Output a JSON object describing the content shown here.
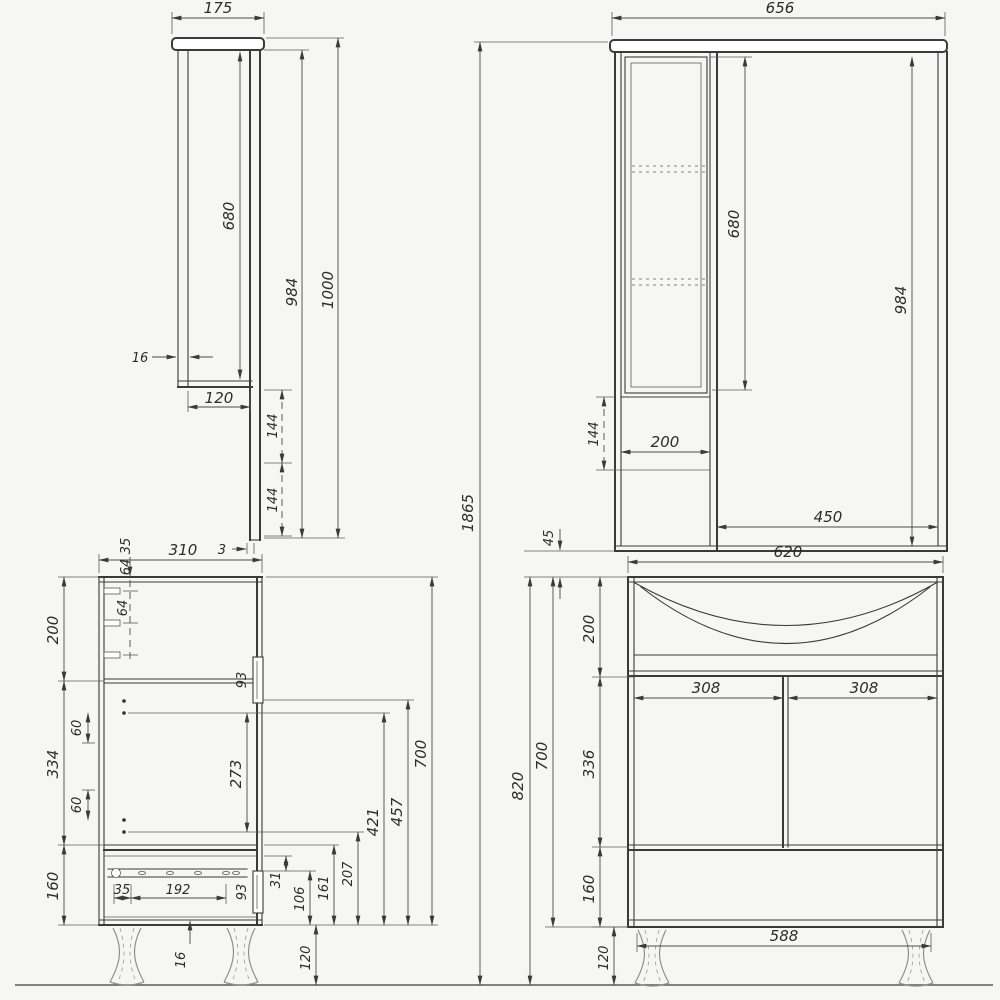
{
  "drawing": {
    "background": "#f6f6f4",
    "line_color": "#3a3a3a",
    "views": {
      "mirror_side": {
        "depth": "175",
        "door_height": "680",
        "height_no_cap": "984",
        "total_height": "1000",
        "panel_thickness": "16",
        "body_depth": "120",
        "lower_ext_1": "144",
        "lower_ext_2": "144",
        "mirror_thickness": "3"
      },
      "mirror_front": {
        "width": "656",
        "door_height": "680",
        "height_no_cap": "984",
        "open_section": "144",
        "cabinet_width": "200",
        "mirror_width": "450",
        "wall_gap": "45"
      },
      "overall": {
        "total_height": "1865"
      },
      "vanity_side": {
        "depth": "310",
        "top_offset": "35",
        "peg_gap_1": "64",
        "peg_gap_2": "64",
        "top_section": "200",
        "mid_section": "334",
        "drawer_section": "160",
        "hinge_offset_top": "60",
        "hinge_offset_bottom": "60",
        "hinge_span": "273",
        "door_handle": "93",
        "drawer_handle": "93",
        "body_height": "700",
        "dim_457": "457",
        "dim_421": "421",
        "dim_207": "207",
        "dim_161": "161",
        "dim_106": "106",
        "dim_31": "31",
        "leg_height": "120",
        "bottom_thickness": "16",
        "slide_offset": "35",
        "slide_span": "192"
      },
      "vanity_front": {
        "width": "620",
        "basin_section": "200",
        "door_width_left": "308",
        "door_width_right": "308",
        "door_section": "336",
        "drawer_section": "160",
        "body_height": "700",
        "total_height": "820",
        "leg_span": "588",
        "leg_height": "120"
      }
    }
  }
}
